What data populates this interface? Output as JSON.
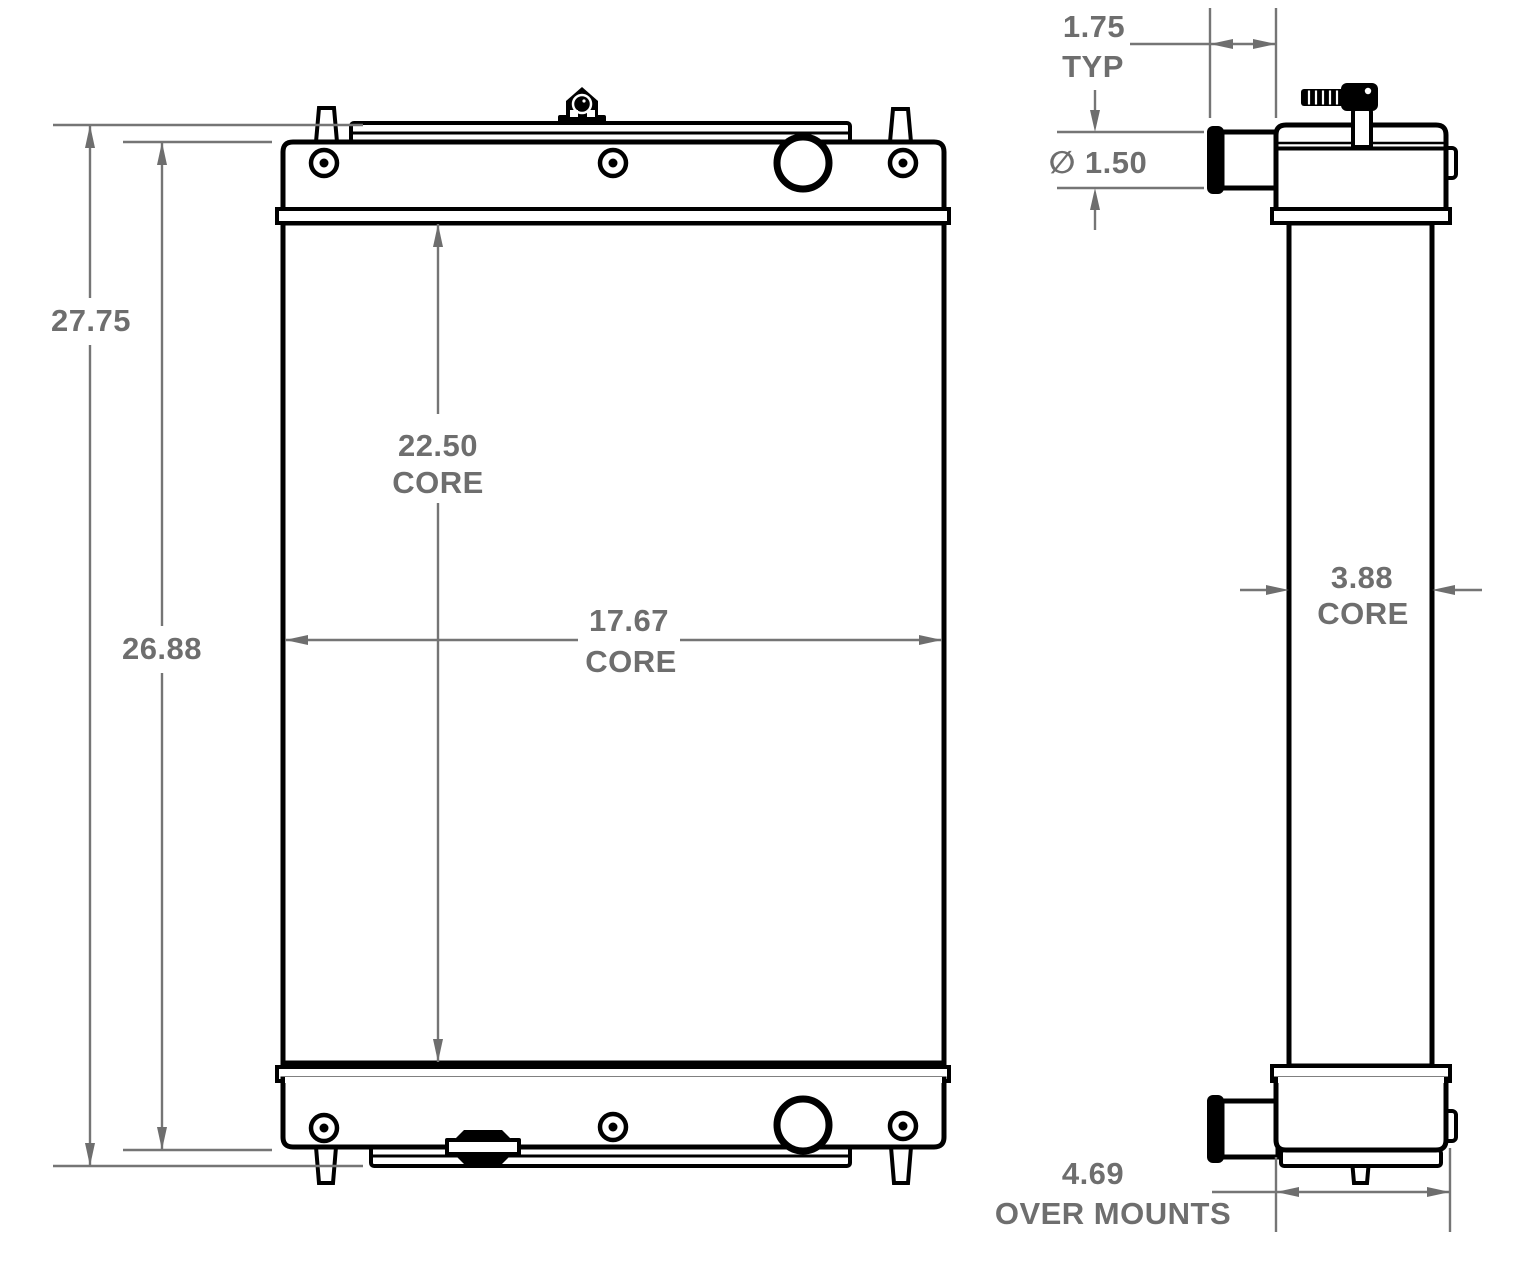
{
  "colors": {
    "outline": "#000000",
    "dimension_gray": "#6e6e6e",
    "background": "#ffffff"
  },
  "dimensions": {
    "overall_height": {
      "value": "27.75"
    },
    "height_over_tanks": {
      "value": "26.88"
    },
    "core_height": {
      "value": "22.50",
      "label": "CORE"
    },
    "core_width": {
      "value": "17.67",
      "label": "CORE"
    },
    "pipe_protrusion": {
      "value": "1.75",
      "label": "TYP"
    },
    "pipe_diameter": {
      "value": "∅ 1.50"
    },
    "core_depth": {
      "value": "3.88",
      "label": "CORE"
    },
    "width_over_mounts": {
      "value": "4.69",
      "label": "OVER MOUNTS"
    }
  }
}
